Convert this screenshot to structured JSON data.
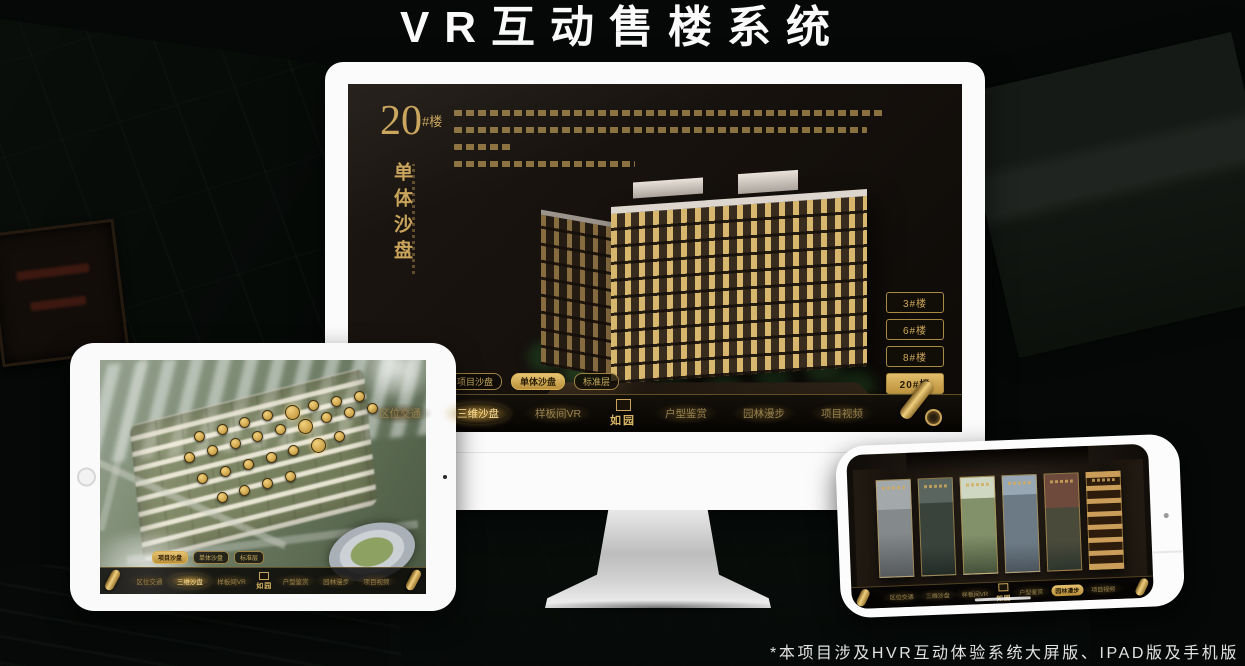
{
  "page": {
    "title": "VR互动售楼系统",
    "footnote": "*本项目涉及HVR互动体验系统大屏版、IPAD版及手机版"
  },
  "colors": {
    "gold": "#c9a24c",
    "gold_text": "#c9a45a",
    "screen_background": "#16110d",
    "nav_text": "#97824e",
    "title_text": "#fafafa"
  },
  "monitor": {
    "headline": {
      "number": "20",
      "suffix": "#楼",
      "vertical_title": "单体沙盘"
    },
    "floor_buttons": [
      {
        "label": "3#楼",
        "active": false
      },
      {
        "label": "6#楼",
        "active": false
      },
      {
        "label": "8#楼",
        "active": false
      },
      {
        "label": "20#楼",
        "active": true
      }
    ],
    "view_tabs": [
      {
        "label": "项目沙盘",
        "active": false
      },
      {
        "label": "单体沙盘",
        "active": true
      },
      {
        "label": "标准层",
        "active": false
      }
    ],
    "nav_items": [
      {
        "label": "区位交通"
      },
      {
        "label": "三维沙盘",
        "active": true
      },
      {
        "label": "样板间VR"
      },
      {
        "label": "如园",
        "logo": true
      },
      {
        "label": "户型鉴赏"
      },
      {
        "label": "园林漫步"
      },
      {
        "label": "项目视频"
      }
    ]
  },
  "ipad": {
    "view_tabs": [
      {
        "label": "项目沙盘",
        "active": true
      },
      {
        "label": "单体沙盘",
        "active": false
      },
      {
        "label": "标准层",
        "active": false
      }
    ],
    "nav_items": [
      {
        "label": "区位交通"
      },
      {
        "label": "三维沙盘",
        "active": true
      },
      {
        "label": "样板间VR"
      },
      {
        "label": "如园",
        "logo": true
      },
      {
        "label": "户型鉴赏"
      },
      {
        "label": "园林漫步"
      },
      {
        "label": "项目视频"
      }
    ],
    "building_markers": [
      [
        30,
        32
      ],
      [
        37,
        29
      ],
      [
        44,
        26
      ],
      [
        51,
        23
      ],
      [
        58,
        21
      ],
      [
        65,
        19
      ],
      [
        72,
        17
      ],
      [
        79,
        15
      ],
      [
        27,
        41
      ],
      [
        34,
        38
      ],
      [
        41,
        35
      ],
      [
        48,
        32
      ],
      [
        55,
        29
      ],
      [
        62,
        27
      ],
      [
        69,
        24
      ],
      [
        76,
        22
      ],
      [
        83,
        20
      ],
      [
        31,
        50
      ],
      [
        38,
        47
      ],
      [
        45,
        44
      ],
      [
        52,
        41
      ],
      [
        59,
        38
      ],
      [
        66,
        35
      ],
      [
        73,
        32
      ],
      [
        37,
        58
      ],
      [
        44,
        55
      ],
      [
        51,
        52
      ],
      [
        58,
        49
      ]
    ]
  },
  "phone": {
    "nav_items": [
      {
        "label": "区位交通"
      },
      {
        "label": "三维沙盘"
      },
      {
        "label": "样板间VR"
      },
      {
        "label": "如园",
        "logo": true
      },
      {
        "label": "户型鉴赏"
      },
      {
        "label": "园林漫步",
        "active": true
      },
      {
        "label": "项目视频"
      }
    ],
    "gallery_panels": [
      {
        "name": "stone-gate"
      },
      {
        "name": "club-lounge"
      },
      {
        "name": "garden-view"
      },
      {
        "name": "residential-tower"
      },
      {
        "name": "autumn-courtyard"
      },
      {
        "name": "wine-cellar"
      }
    ]
  }
}
